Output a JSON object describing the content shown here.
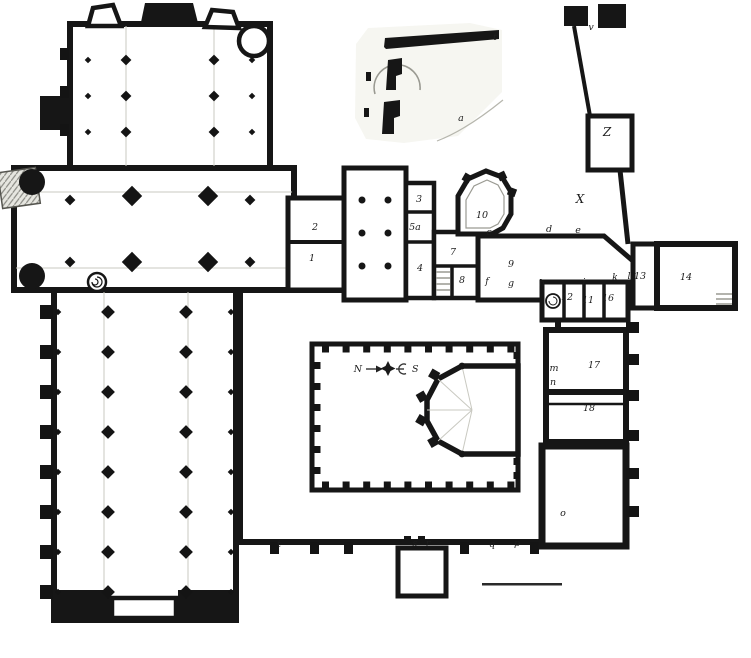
{
  "colors": {
    "ink": "#161616",
    "vault_line": "#c0c0b8",
    "paper": "#ffffff",
    "tint": "#f3f3ed"
  },
  "compass": {
    "north": "N",
    "south": "S"
  },
  "rooms": {
    "church": "cruciform church with nave, transept and chevet",
    "cloister": "square cloister with garth and fountain pavilion",
    "inset": "detail plan of small chapel"
  },
  "labels": [
    {
      "text": "t",
      "x": 495,
      "y": 40
    },
    {
      "text": "a",
      "x": 461,
      "y": 121
    },
    {
      "text": "v",
      "x": 591,
      "y": 30
    },
    {
      "text": "Z",
      "x": 607,
      "y": 136
    },
    {
      "text": "X",
      "x": 580,
      "y": 203
    },
    {
      "text": "2",
      "x": 315,
      "y": 230
    },
    {
      "text": "1",
      "x": 312,
      "y": 261
    },
    {
      "text": "3",
      "x": 419,
      "y": 202
    },
    {
      "text": "5a",
      "x": 415,
      "y": 230
    },
    {
      "text": "4",
      "x": 420,
      "y": 271
    },
    {
      "text": "7",
      "x": 453,
      "y": 255
    },
    {
      "text": "8",
      "x": 462,
      "y": 283
    },
    {
      "text": "10",
      "x": 482,
      "y": 218
    },
    {
      "text": "c",
      "x": 489,
      "y": 235
    },
    {
      "text": "d",
      "x": 549,
      "y": 232
    },
    {
      "text": "e",
      "x": 578,
      "y": 233
    },
    {
      "text": "9",
      "x": 511,
      "y": 267
    },
    {
      "text": "f",
      "x": 487,
      "y": 284
    },
    {
      "text": "g",
      "x": 511,
      "y": 286
    },
    {
      "text": "h",
      "x": 542,
      "y": 286
    },
    {
      "text": "i",
      "x": 584,
      "y": 285
    },
    {
      "text": "k",
      "x": 615,
      "y": 280
    },
    {
      "text": "l",
      "x": 629,
      "y": 279
    },
    {
      "text": "13",
      "x": 640,
      "y": 279
    },
    {
      "text": "14",
      "x": 686,
      "y": 280
    },
    {
      "text": "12",
      "x": 567,
      "y": 300
    },
    {
      "text": "11",
      "x": 588,
      "y": 303
    },
    {
      "text": "16",
      "x": 608,
      "y": 301
    },
    {
      "text": "m",
      "x": 554,
      "y": 371
    },
    {
      "text": "17",
      "x": 594,
      "y": 368
    },
    {
      "text": "n",
      "x": 553,
      "y": 385
    },
    {
      "text": "18",
      "x": 589,
      "y": 411
    },
    {
      "text": "o",
      "x": 563,
      "y": 516
    },
    {
      "text": "t",
      "x": 279,
      "y": 547
    },
    {
      "text": "s",
      "x": 415,
      "y": 546
    },
    {
      "text": "r",
      "x": 428,
      "y": 546
    },
    {
      "text": "q",
      "x": 492,
      "y": 547
    },
    {
      "text": "p",
      "x": 517,
      "y": 546
    }
  ]
}
